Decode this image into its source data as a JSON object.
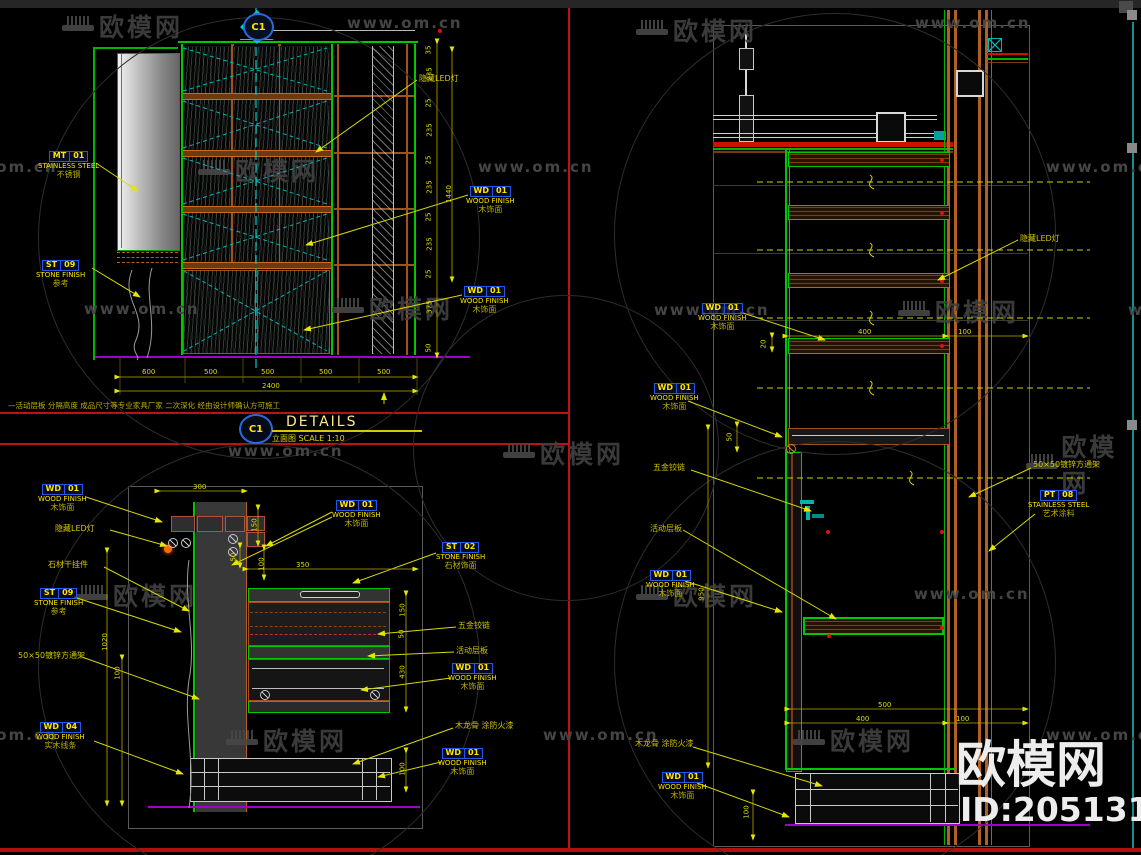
{
  "watermark": {
    "logo": "欧模网",
    "url": "www.om.cn",
    "big": "欧模网",
    "id": "ID:2051312"
  },
  "title_block": {
    "ref": "C1",
    "title": "DETAILS",
    "subtitle": "立面图 SCALE 1:10"
  },
  "marker": {
    "ref": "C1"
  },
  "note": "—活动层板 分隔高度 成品尺寸等专业家具厂家 二次深化 经由设计师确认方可施工",
  "materials": {
    "mt01": {
      "code": "MT",
      "num": "01",
      "en": "STAINLESS STEEL",
      "cn": "不锈钢"
    },
    "st09": {
      "code": "ST",
      "num": "09",
      "en": "STONE FINISH",
      "cn": "参考"
    },
    "st02": {
      "code": "ST",
      "num": "02",
      "en": "STONE FINISH",
      "cn": "石材饰面"
    },
    "wd01": {
      "code": "WD",
      "num": "01",
      "en": "WOOD FINISH",
      "cn": "木饰面"
    },
    "wd04": {
      "code": "WD",
      "num": "04",
      "en": "WOOD FINISH",
      "cn": "实木线条"
    },
    "pt08": {
      "code": "PT",
      "num": "08",
      "en": "STAINLESS STEEL",
      "cn": "艺术涂料"
    }
  },
  "annotations": {
    "led": "隐藏LED灯",
    "stone_hanger": "石材干挂件",
    "tube": "50×50镀锌方通架",
    "hinge": "五金铰链",
    "shelf": "活动层板",
    "keel": "木龙骨 涂防火漆"
  },
  "dims": {
    "elev_bottom": [
      "600",
      "500",
      "500",
      "500",
      "500"
    ],
    "elev_bottom_total": "2400",
    "elev_right": [
      "35",
      "235",
      "25",
      "235",
      "25",
      "235",
      "25",
      "235",
      "25",
      "375",
      "50"
    ],
    "elev_right_total": "1440",
    "plan": {
      "w300": "300",
      "h150": "150",
      "h50": "50",
      "h100": "100",
      "w350": "350",
      "r150": "150",
      "r50": "50",
      "r430": "430",
      "r100": "100",
      "l1020": "1020",
      "l100": "100"
    },
    "sect": {
      "t400": "400",
      "t100": "100",
      "t20": "20",
      "d50": "50",
      "d950": "950",
      "b500": "500",
      "b400": "400",
      "b100": "100",
      "l100": "100"
    }
  }
}
